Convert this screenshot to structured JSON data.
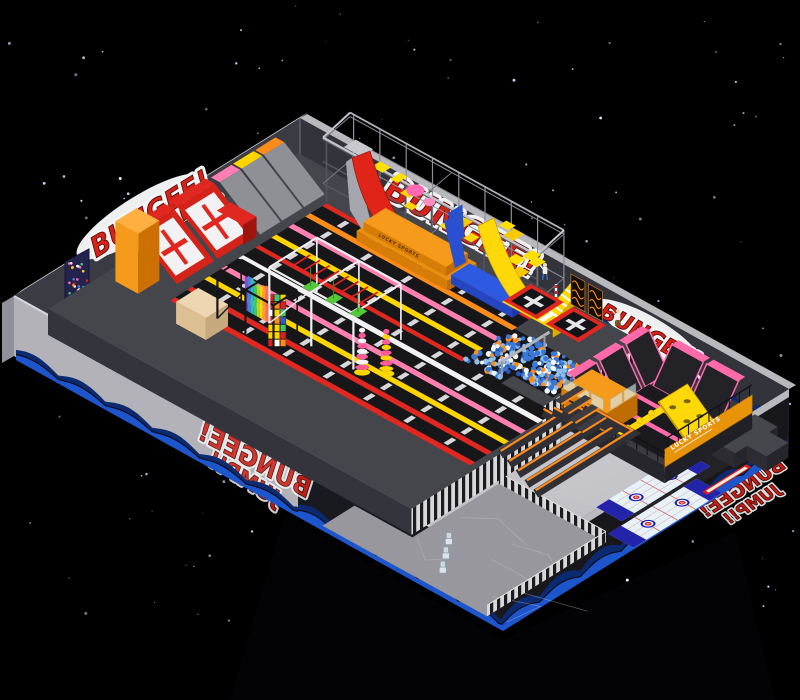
{
  "graffiti": {
    "bungee": "BUNGEE!",
    "jump": "JUMP!!"
  },
  "branding": {
    "banner_title": "LUCKY SPORTS",
    "podium_label": "LUCKY SPORTS"
  },
  "palette": {
    "background": "#000000",
    "graffiti_red": "#d42318",
    "wall_back_left": "#3b3b43",
    "wall_back_right": "#33333b",
    "wall_front_light": "#b2b2b8",
    "wall_front_dark": "#191920",
    "floor_light": "#dfdfe2",
    "floor_dark": "#bdbdc3",
    "platform": "#45454c",
    "lane_black": "#17171a",
    "stripe_red": "#e02820",
    "stripe_orange": "#ff8c1a",
    "stripe_pink": "#ff7fb0",
    "stripe_yellow": "#ffd500",
    "stripe_white": "#f2f2f4",
    "wave_blue": "#1d55cc",
    "wave_deep": "#0b2a70",
    "slide_red": "#e02418",
    "slide_blue": "#2a50d0",
    "slide_yellow": "#ffd80a",
    "accent_orange": "#f59a1a",
    "ball_colors": [
      "#3a78d8",
      "#8fc0ea",
      "#f2f6f8",
      "#ff8c1a",
      "#2458b8"
    ],
    "rainbow": [
      "#7a4fd0",
      "#4a7fe0",
      "#2fb8c8",
      "#3ec86a",
      "#a8d830",
      "#ffd500",
      "#ff9a3a",
      "#ff6a5a"
    ],
    "block_colors": [
      "#e02020",
      "#ffd500",
      "#2a5fd0",
      "#3ec86a",
      "#ffffff",
      "#ff8c1a"
    ]
  }
}
